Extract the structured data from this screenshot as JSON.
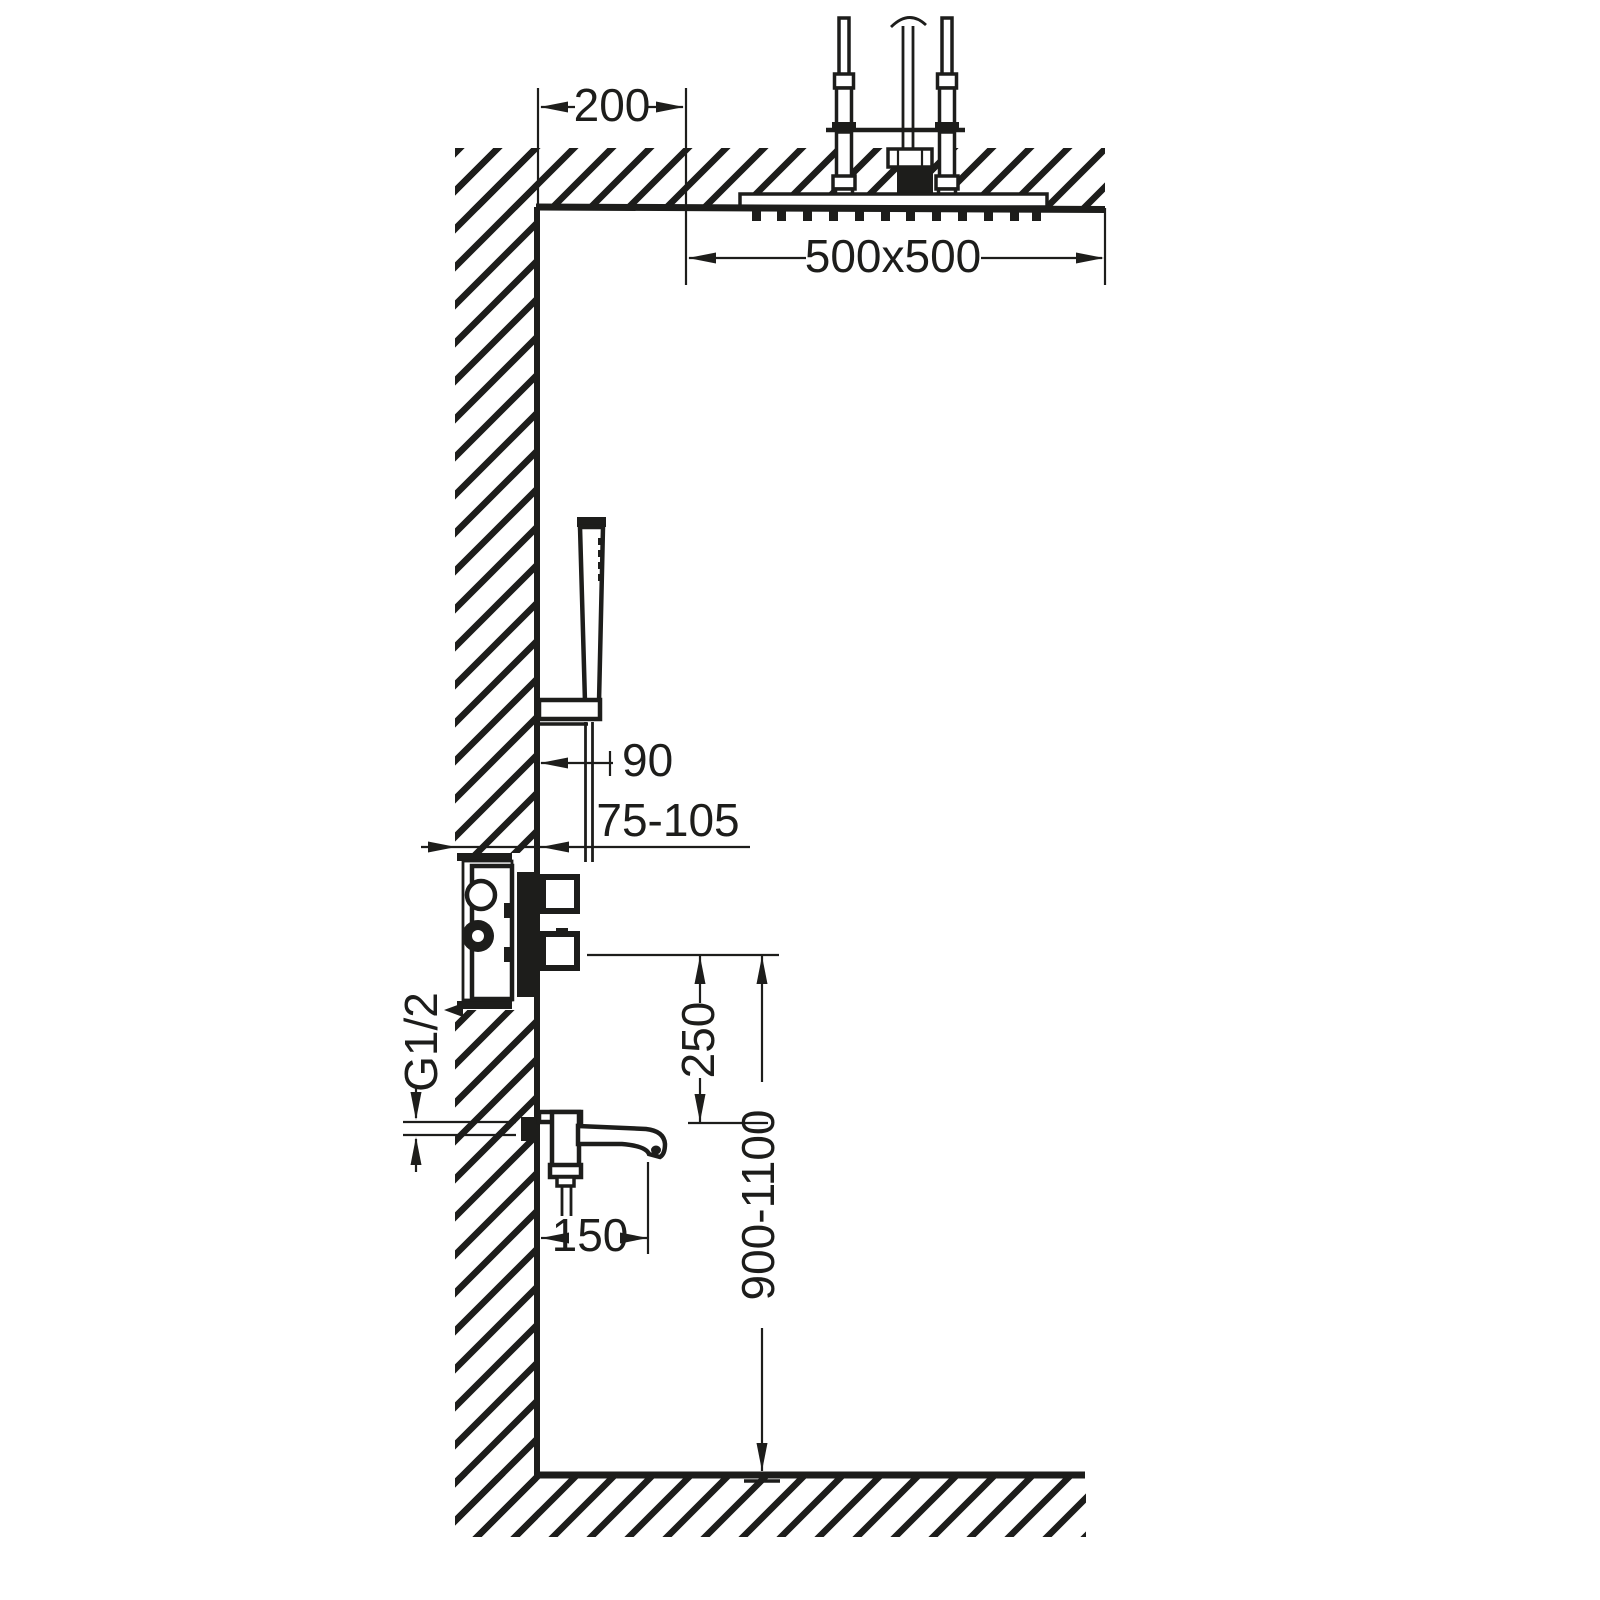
{
  "diagram": {
    "background": "#ffffff",
    "ink": "#1d1d1b",
    "dimensions": {
      "head_ceiling_offset": "200",
      "head_size": "500x500",
      "hand_shower_wall_offset": "90",
      "valve_install_depth_range": "75-105",
      "valve_to_spout_distance": "250",
      "valve_mounting_height_range": "900-1100",
      "spout_projection": "150",
      "pipe_thread": "G1/2"
    }
  }
}
